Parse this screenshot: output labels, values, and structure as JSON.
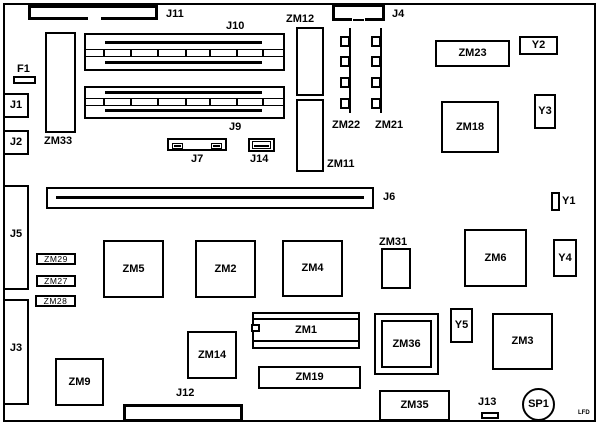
{
  "diagram": {
    "type": "pcb-component-layout",
    "colors": {
      "line": "#000000",
      "background": "#ffffff",
      "text": "#000000"
    }
  },
  "labels": {
    "j1": "J1",
    "j2": "J2",
    "j3": "J3",
    "j4": "J4",
    "j5": "J5",
    "j6": "J6",
    "j7": "J7",
    "j9": "J9",
    "j10": "J10",
    "j11": "J11",
    "j12": "J12",
    "j13": "J13",
    "j14": "J14",
    "f1": "F1",
    "zm33": "ZM33",
    "zm12": "ZM12",
    "zm11": "ZM11",
    "zm22": "ZM22",
    "zm21": "ZM21",
    "zm23": "ZM23",
    "zm18": "ZM18",
    "y1": "Y1",
    "y2": "Y2",
    "y3": "Y3",
    "y4": "Y4",
    "y5": "Y5",
    "zm29": "ZM29",
    "zm27": "ZM27",
    "zm28": "ZM28",
    "zm5": "ZM5",
    "zm2": "ZM2",
    "zm4": "ZM4",
    "zm31": "ZM31",
    "zm6": "ZM6",
    "zm9": "ZM9",
    "zm14": "ZM14",
    "zm1": "ZM1",
    "zm36": "ZM36",
    "zm3": "ZM3",
    "zm19": "ZM19",
    "zm35": "ZM35",
    "sp1": "SP1",
    "corner_mark": "LFD"
  }
}
